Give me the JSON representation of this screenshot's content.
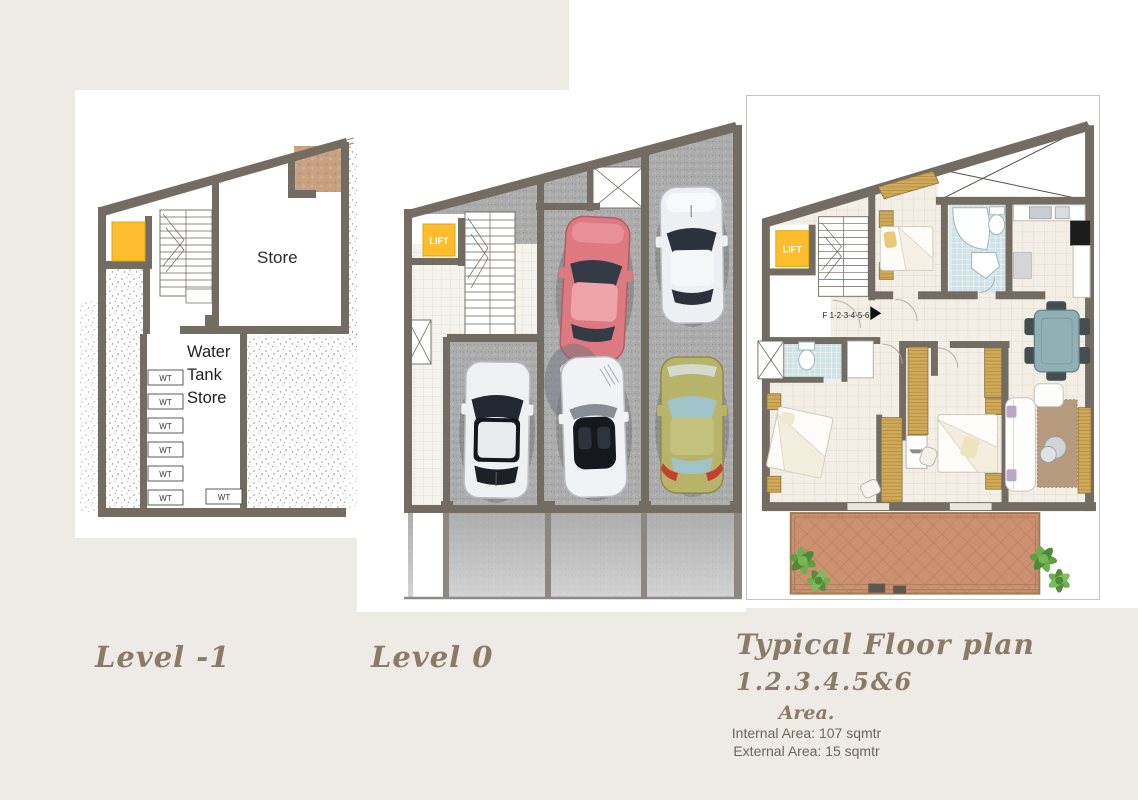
{
  "page": {
    "background_color": "#eeeae5",
    "accent_yellow": "#fdbd2d",
    "wall_color": "#736c63",
    "script_text_color": "#8a7b67"
  },
  "plans": {
    "level_minus1": {
      "label": "Level -1",
      "store_label": "Store",
      "water_tank": [
        "Water",
        "Tank",
        "Store"
      ],
      "wt_label": "WT"
    },
    "level_0": {
      "label": "Level 0",
      "lift_label": "LIFT"
    },
    "typical": {
      "title": "Typical Floor plan",
      "subtitle": "1.2.3.4.5&6",
      "area_heading": "Area.",
      "internal_area": "Internal Area: 107 sqmtr",
      "external_area": "External Area: 15 sqmtr",
      "lift_label": "LIFT",
      "flat_ref": "F 1-2-3-4-5-6"
    }
  }
}
